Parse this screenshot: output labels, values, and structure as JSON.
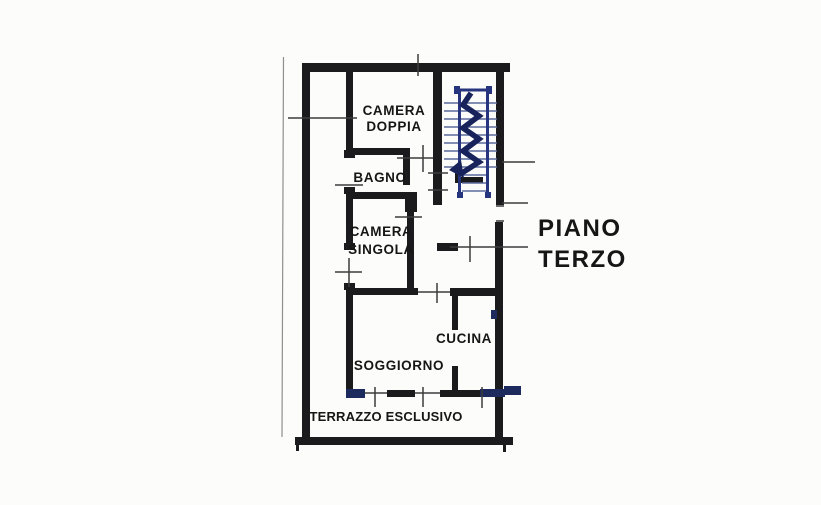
{
  "document_title": "Floor plan scan",
  "floor_label": {
    "line1": "PIANO",
    "line2": "TERZO"
  },
  "rooms": {
    "camera_doppia": {
      "line1": "CAMERA",
      "line2": "DOPPIA"
    },
    "bagno": {
      "label": "BAGNO"
    },
    "camera_singola": {
      "line1": "CAMERA",
      "line2": "SINGOLA"
    },
    "cucina": {
      "label": "CUCINA"
    },
    "soggiorno": {
      "label": "SOGGIORNO"
    },
    "terrazzo": {
      "label": "TERRAZZO ESCLUSIVO"
    }
  },
  "icons": {
    "staircase": "staircase-symbol"
  },
  "colors": {
    "background": "#fcfcfa",
    "wall": "#1b1b1d",
    "blue_dark": "#1c2a5e",
    "stair_rail": "#27357f",
    "stair_tread": "#5a6a9d",
    "stair_arrow": "#18235c",
    "thin_line": "#3c3c3c",
    "text": "#161616",
    "fold_line": "#8f8f8f"
  }
}
